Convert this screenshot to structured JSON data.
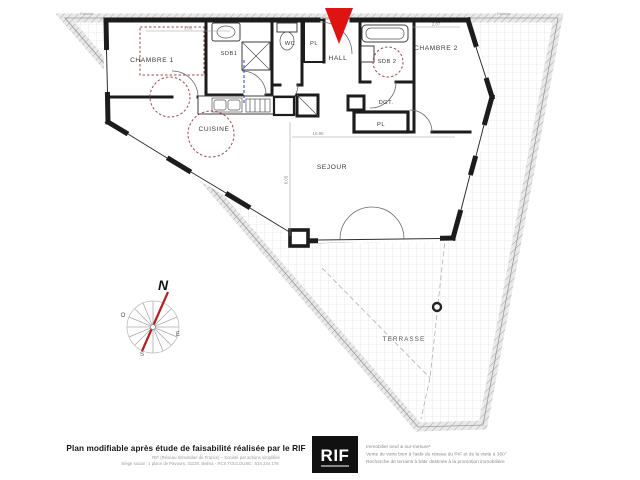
{
  "plan": {
    "rooms": {
      "chambre1": "CHAMBRE 1",
      "sdb1": "SDB1",
      "wc": "WC",
      "pl_hall": "PL",
      "hall": "HALL",
      "sdb2": "SDB 2",
      "chambre2": "CHAMBRE 2",
      "dgt": "DGT.",
      "pl_dgt": "PL",
      "cuisine": "CUISINE",
      "sejour": "SEJOUR",
      "terrasse": "TERRASSE"
    },
    "dimensions": {
      "chambre1_width": "3.80",
      "chambre2_width": "2.87",
      "sejour_width": "10.90",
      "sejour_depth": "6.05"
    },
    "site_labels": {
      "top_left": "Palmier",
      "top_right": "Palmier"
    },
    "compass": {
      "north": "N",
      "west": "O",
      "east": "E",
      "south": "S"
    },
    "colors": {
      "wall": "#1c1c1c",
      "entrance_arrow": "#e01313",
      "furniture_dashed": "#a14d4f",
      "plumbing_line": "#2b3fd0",
      "terrace_grid": "#dadada"
    }
  },
  "footer": {
    "left": {
      "title": "Plan modifiable après étude de faisabilité réalisée par le RIF",
      "line1": "RIF (Réseau Immobilier de France) – Société par actions simplifiée",
      "line2": "Siège social : 1 place de Pavours, 31130, Balma - RCS TOULOUSE : 534 234 178"
    },
    "logo": "RIF",
    "right": {
      "line1": "Immobilier neuf & sur-mesure*",
      "line2": "Vente de votre bien à l'aide du réseau du RIF et de la visite à 360°",
      "line3": "Recherche de terrains à bâtir destinés à la promotion immobilière"
    }
  }
}
